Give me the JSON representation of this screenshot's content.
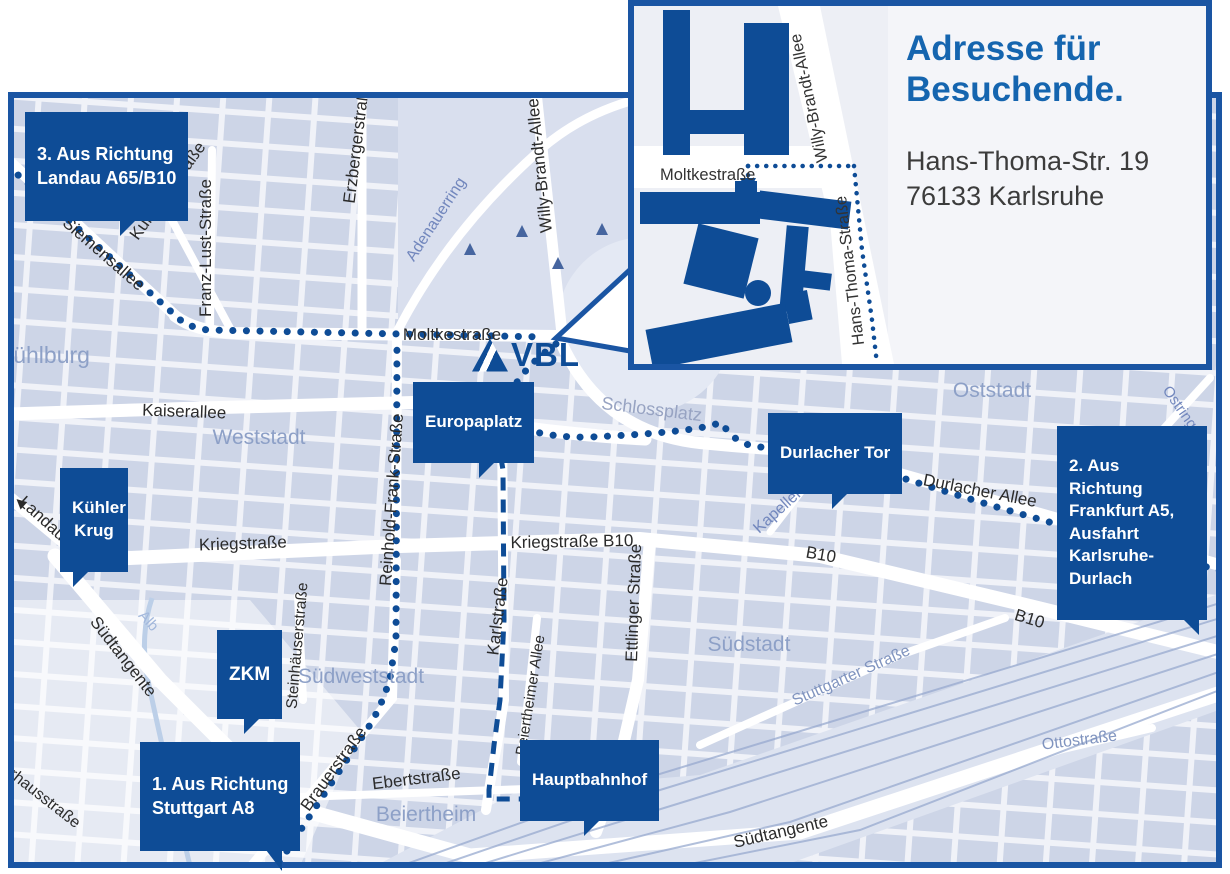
{
  "colors": {
    "brand_blue": "#0e4c96",
    "border_blue": "#1a55a3",
    "title_blue": "#1565af",
    "map_background": "#f0f2f8",
    "city_block": "#cdd5e7",
    "district_label": "#8da0c7",
    "street_label_dark": "#2b2b2b",
    "street_label_blue": "#7287bd",
    "water_blue": "#a3b8dc"
  },
  "logo": {
    "text": "VBL"
  },
  "inset": {
    "title": "Adresse für\nBesuchende.",
    "address_line1": "Hans-Thoma-Str. 19",
    "address_line2": "76133 Karlsruhe",
    "streets": {
      "moltkestrasse": "Moltkestraße",
      "willy_brandt_allee": "Willy-Brandt-Allee",
      "hans_thoma_strasse": "Hans-Thoma-Straße"
    }
  },
  "callouts": {
    "landau": {
      "label": "3. Aus Richtung\nLandau A65/B10"
    },
    "frankfurt": {
      "label": "2. Aus Richtung\nFrankfurt A5,\nAusfahrt\nKarlsruhe-Durlach"
    },
    "stuttgart": {
      "label": "1. Aus Richtung\nStuttgart A8"
    },
    "europaplatz": {
      "label": "Europaplatz"
    },
    "durlacher_tor": {
      "label": "Durlacher Tor"
    },
    "kuehler_krug": {
      "label": "Kühler\nKrug"
    },
    "zkm": {
      "label": "ZKM"
    },
    "hauptbahnhof": {
      "label": "Hauptbahnhof"
    }
  },
  "districts": {
    "muehlburg": "Mühlburg",
    "weststadt": "Weststadt",
    "oststadt": "Oststadt",
    "suedstadt": "Südstadt",
    "suedweststadt": "Südweststadt",
    "beiertheim": "Beiertheim"
  },
  "streets": {
    "siemensallee": "Siemensallee",
    "kussmaulstrasse": "Kußmaulstraße",
    "franz_lust_strasse": "Franz-Lust-Straße",
    "erzbergerstrasse": "Erzbergerstraße",
    "willy_brandt_allee": "Willy-Brandt-Allee",
    "moltkestrasse": "Moltkestraße",
    "kaiserallee": "Kaiserallee",
    "landau_b10": "Landau B10",
    "kriegstrasse": "Kriegstraße",
    "kriegstrasse_b10": "Kriegstraße B10",
    "reinhold_frank_strasse": "Reinhold-Frank-Straße",
    "karlstrasse": "Karlstraße",
    "ettlinger_strasse": "Ettlinger Straße",
    "durlacher_allee": "Durlacher Allee",
    "b10_mid": "B10",
    "b10_right": "B10",
    "suedtangente_left": "Südtangente",
    "suedtangente_bottom": "Südtangente",
    "steinhaeuserstrasse": "Steinhäuserstraße",
    "brauerstrasse": "Brauerstraße",
    "ebertstrasse": "Ebertstraße",
    "beiertheimer_allee": "Beiertheimer Allee",
    "pulverhausstrasse": "Pulverhausstraße",
    "adenauerring": "Adenauerring",
    "schlossplatz": "Schlossplatz",
    "kapellenstrasse": "Kapellenstraße",
    "ostring": "Ostring",
    "stuttgarter_strasse": "Stuttgarter Straße",
    "ottostrasse": "Ottostraße",
    "alb": "Alb"
  },
  "glyphs": {
    "left_arrow": "◀"
  }
}
